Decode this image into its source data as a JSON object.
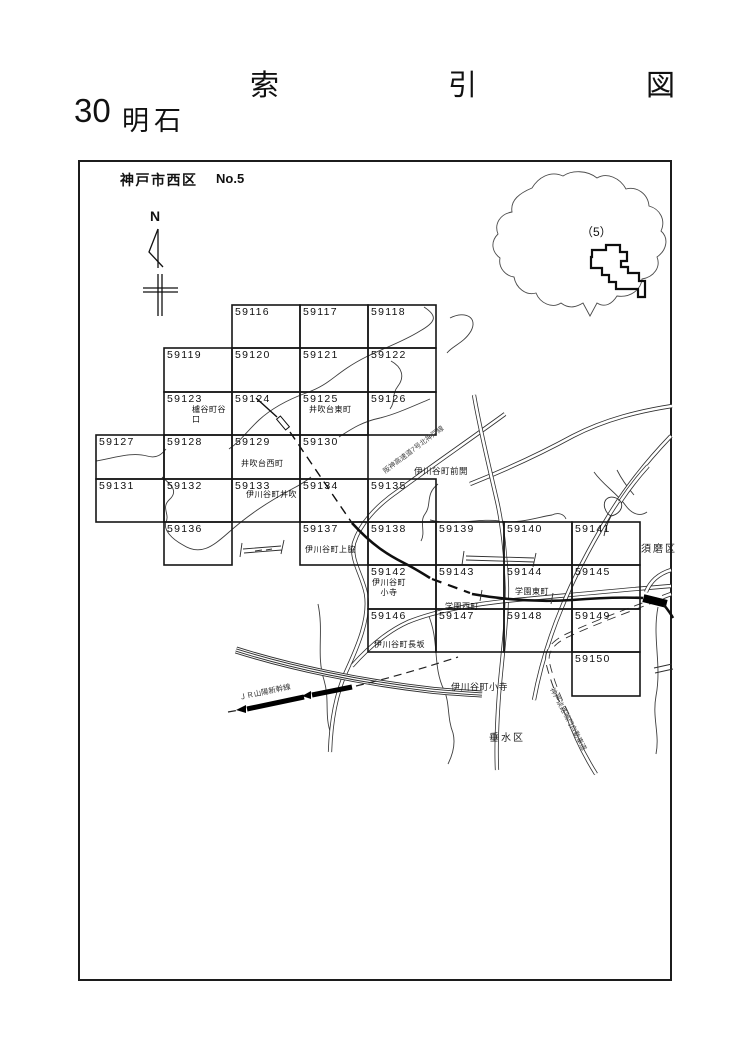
{
  "header": {
    "title": "索　引　図",
    "sheet_no": "30",
    "sheet_name": "明石",
    "region": "神戸市西区",
    "map_no": "No.5"
  },
  "compass": {
    "north": "N"
  },
  "inset": {
    "label": "（5）"
  },
  "grid": {
    "cells": [
      {
        "id": "59116",
        "name": ""
      },
      {
        "id": "59117",
        "name": ""
      },
      {
        "id": "59118",
        "name": ""
      },
      {
        "id": "59119",
        "name": ""
      },
      {
        "id": "59120",
        "name": ""
      },
      {
        "id": "59121",
        "name": ""
      },
      {
        "id": "59122",
        "name": ""
      },
      {
        "id": "59123",
        "name": "櫨谷町谷口"
      },
      {
        "id": "59124",
        "name": ""
      },
      {
        "id": "59125",
        "name": "井吹台東町"
      },
      {
        "id": "59126",
        "name": ""
      },
      {
        "id": "59127",
        "name": ""
      },
      {
        "id": "59128",
        "name": ""
      },
      {
        "id": "59129",
        "name": "井吹台西町"
      },
      {
        "id": "59130",
        "name": ""
      },
      {
        "id": "59131",
        "name": ""
      },
      {
        "id": "59132",
        "name": ""
      },
      {
        "id": "59133",
        "name": "伊川谷町井吹"
      },
      {
        "id": "59134",
        "name": ""
      },
      {
        "id": "59135",
        "name": ""
      },
      {
        "id": "59136",
        "name": ""
      },
      {
        "id": "59137",
        "name": "伊川谷町上脇"
      },
      {
        "id": "59138",
        "name": ""
      },
      {
        "id": "59139",
        "name": ""
      },
      {
        "id": "59140",
        "name": ""
      },
      {
        "id": "59141",
        "name": ""
      },
      {
        "id": "59142",
        "name": "伊川谷町\n小寺"
      },
      {
        "id": "59143",
        "name": "学園西町"
      },
      {
        "id": "59144",
        "name": "学園東町"
      },
      {
        "id": "59145",
        "name": ""
      },
      {
        "id": "59146",
        "name": "伊川谷町長坂"
      },
      {
        "id": "59147",
        "name": ""
      },
      {
        "id": "59148",
        "name": ""
      },
      {
        "id": "59149",
        "name": ""
      },
      {
        "id": "59150",
        "name": ""
      }
    ]
  },
  "map_labels": {
    "maekai": "伊川谷町前開",
    "suma_ku": "須磨区",
    "tarumi_ku": "垂水区",
    "kodera_south": "伊川谷町小寺",
    "jr_sanyo": "ＪＲ山陽新幹線",
    "hanshin_exp": "阪神高速道7号北神戸線",
    "kobe_awaji_naruto": "神戸淡路鳴門自動車道"
  }
}
